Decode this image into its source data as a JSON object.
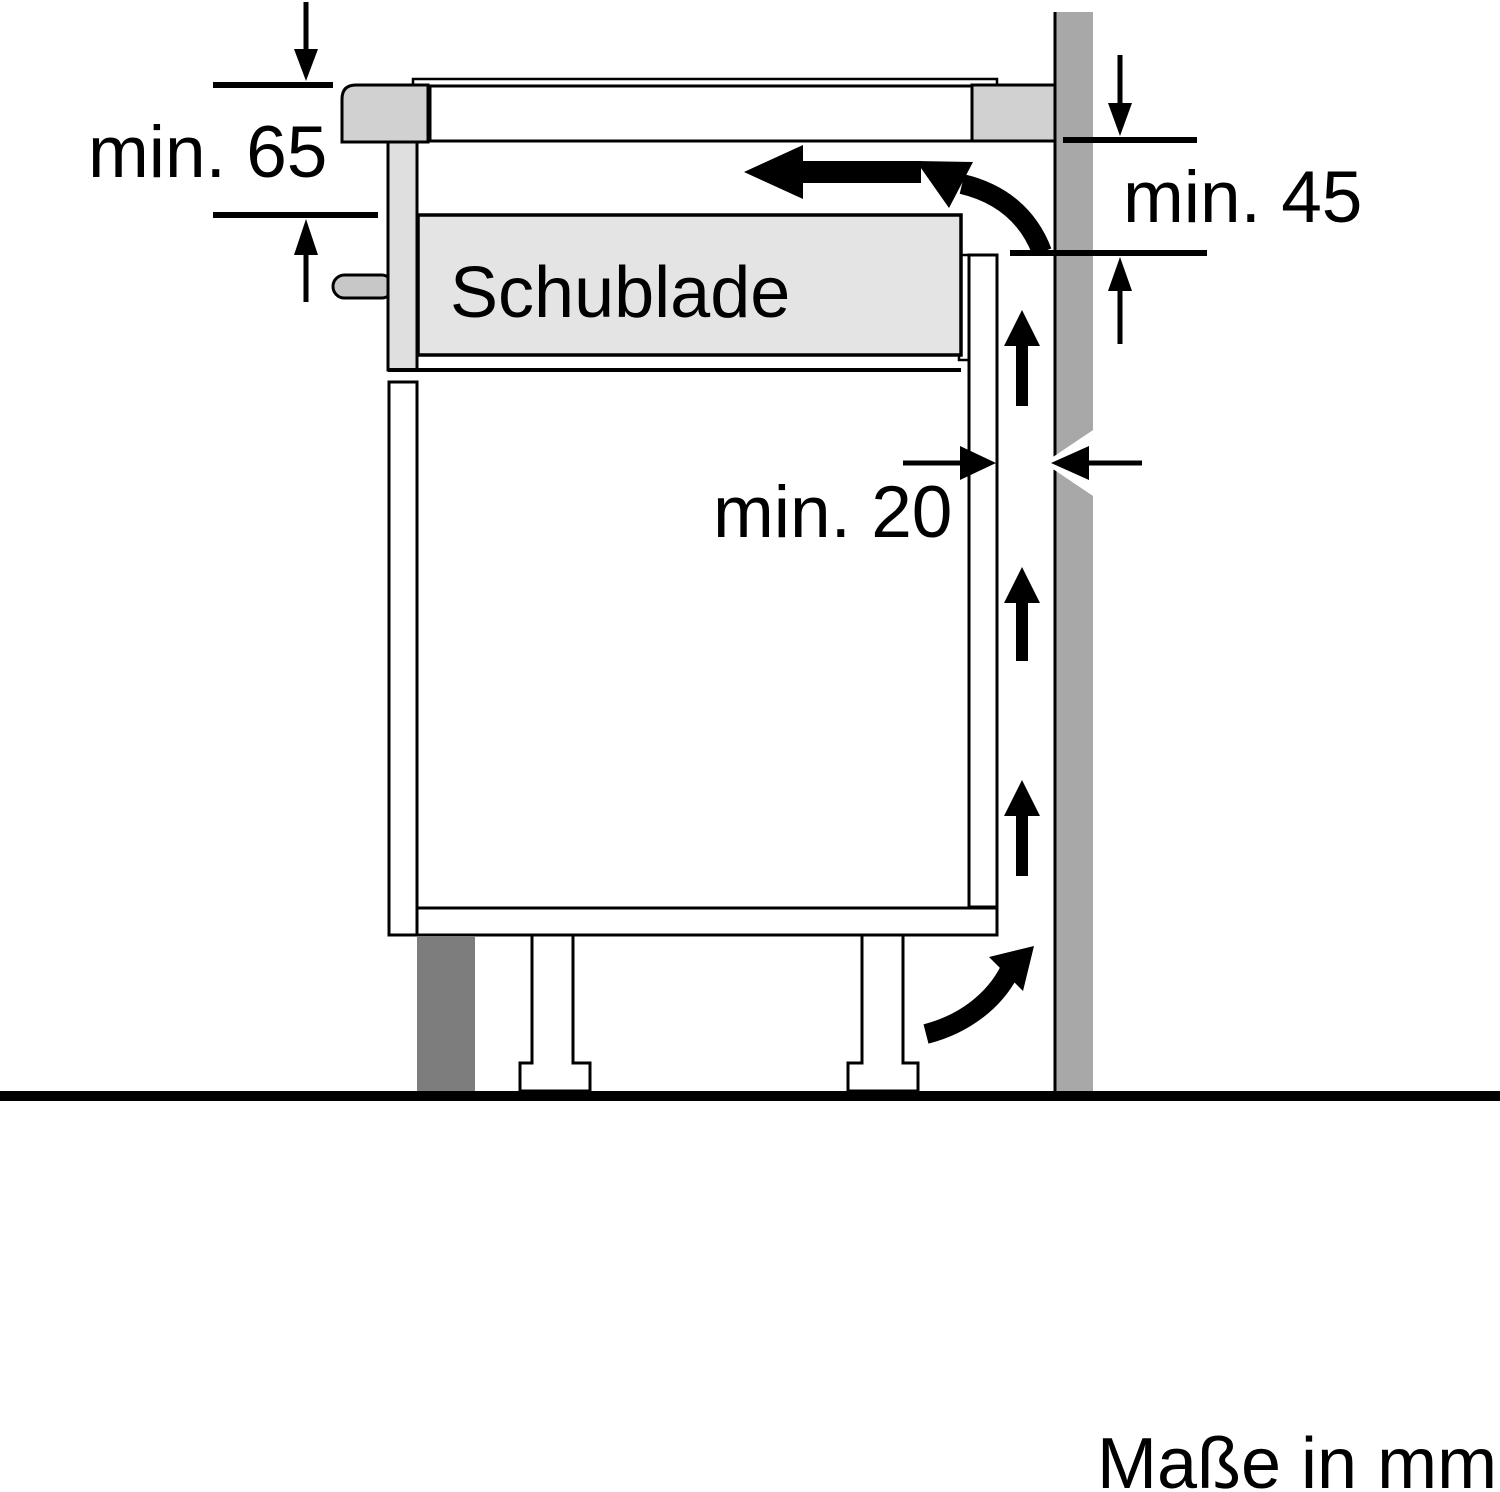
{
  "diagram": {
    "title_hidden": "",
    "labels": {
      "dim_top_left": "min. 65",
      "dim_top_right": "min. 45",
      "dim_rear_gap": "min. 20",
      "drawer": "Schublade",
      "units_note": "Maße in mm"
    },
    "colors": {
      "background": "#ffffff",
      "line": "#000000",
      "wall": "#a8a8a8",
      "hob_trim": "#d1d1d1",
      "hob_rear_support": "#d1d1d1",
      "front_strip": "#dfdfdf",
      "drawer_box": "#e4e4e4",
      "handle": "#c7c7c7",
      "plinth": "#7d7d7d",
      "cabinet_fill": "#ffffff"
    }
  }
}
